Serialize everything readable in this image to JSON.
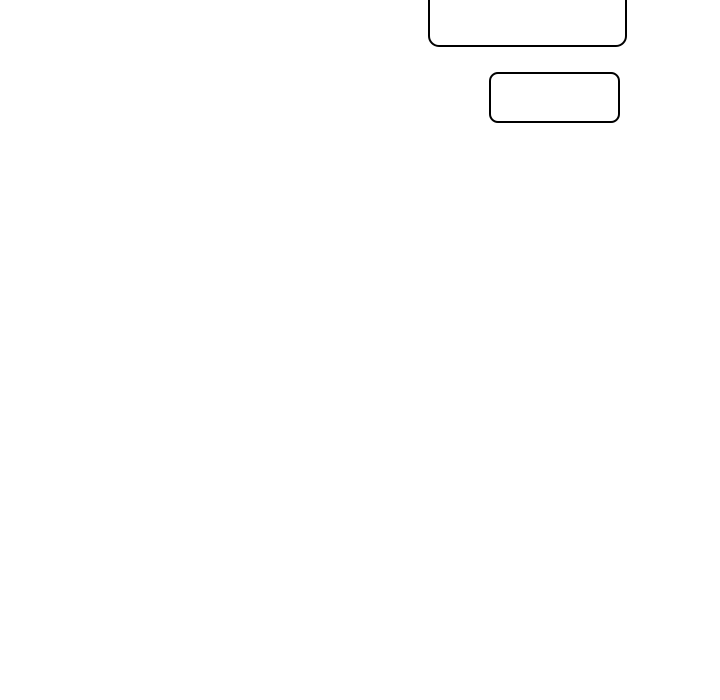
{
  "canvas": {
    "background_color": "#ffffff"
  },
  "diagram": {
    "nodes": [
      {
        "id": "node-top",
        "shape": "rounded-rectangle",
        "label": "",
        "border_color": "#000000",
        "fill_color": "#ffffff"
      },
      {
        "id": "node-bottom",
        "shape": "rounded-rectangle",
        "label": "",
        "border_color": "#000000",
        "fill_color": "#ffffff"
      }
    ]
  }
}
